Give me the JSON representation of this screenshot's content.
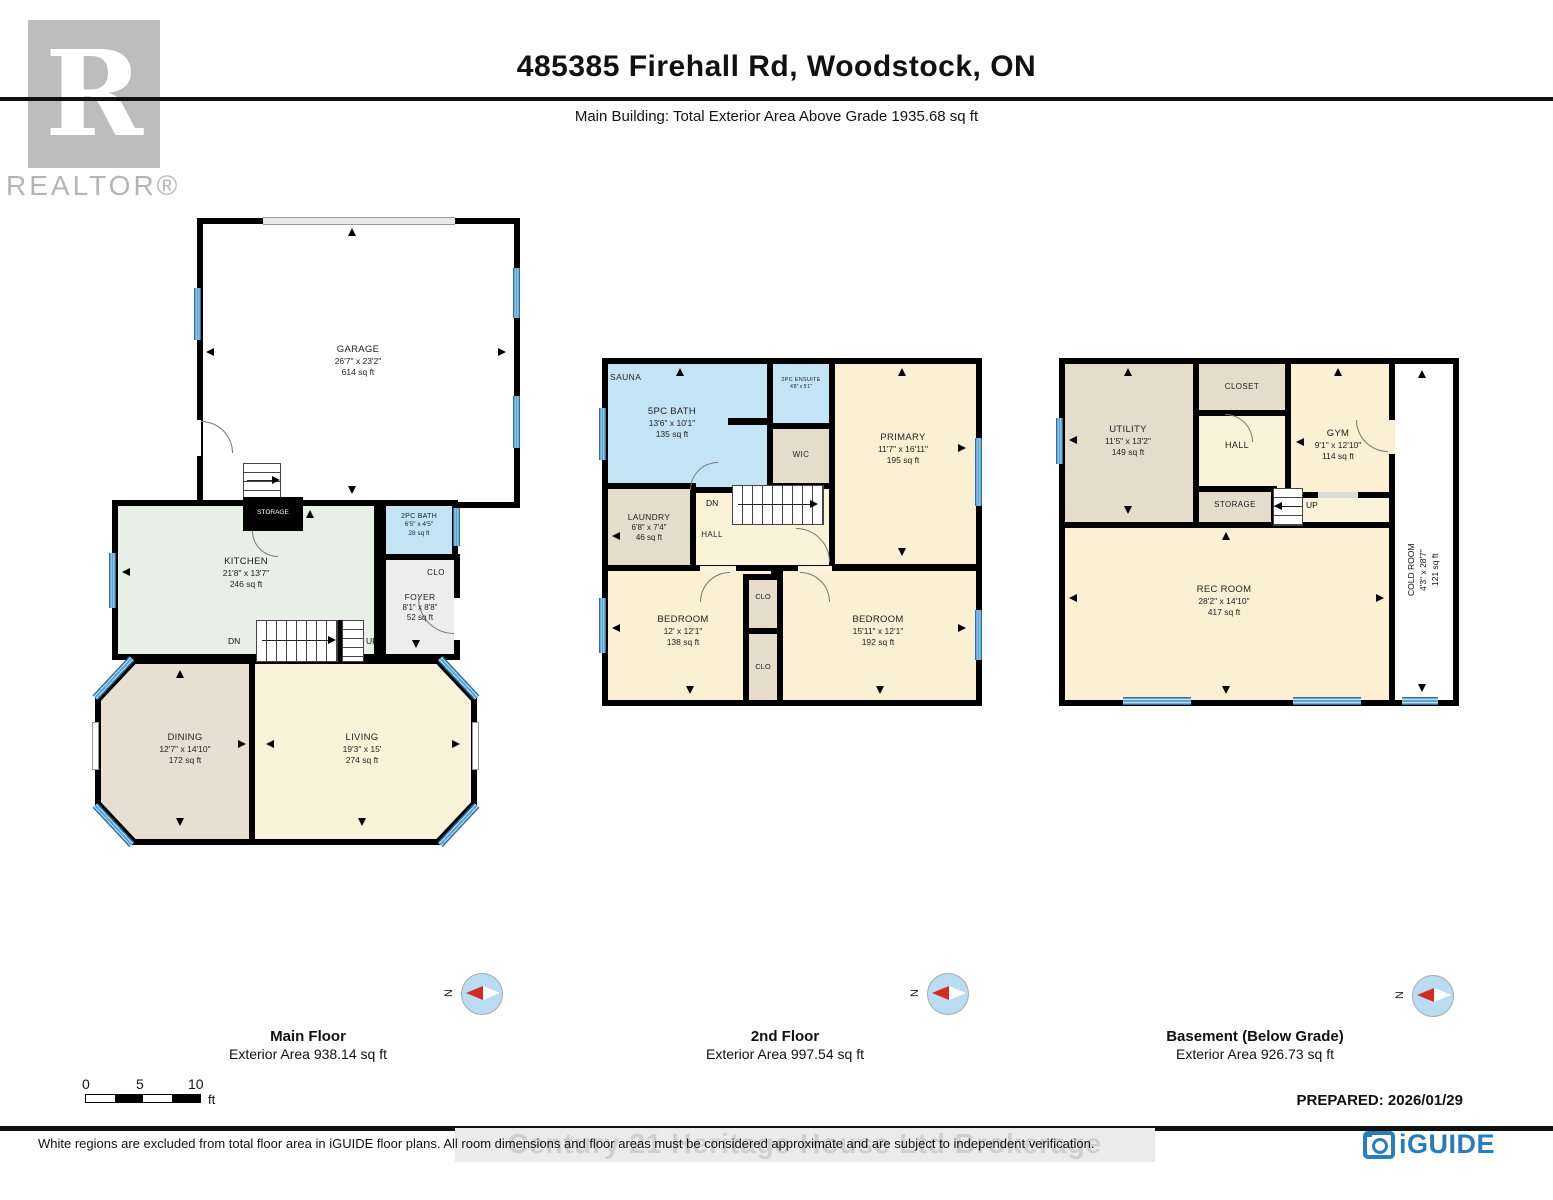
{
  "header": {
    "title": "485385 Firehall Rd, Woodstock, ON",
    "subtitle": "Main Building: Total Exterior Area Above Grade 1935.68 sq ft"
  },
  "branding": {
    "realtor_r": "R",
    "realtor_text": "REALTOR®",
    "iguide_text": "iGUIDE"
  },
  "floors": {
    "main": {
      "caption": {
        "title": "Main Floor",
        "area": "Exterior Area 938.14 sq ft"
      },
      "rooms": {
        "garage": {
          "name": "GARAGE",
          "dims": "26'7\" x 23'2\"",
          "area": "614 sq ft"
        },
        "kitchen": {
          "name": "KITCHEN",
          "dims": "21'8\" x 13'7\"",
          "area": "246 sq ft"
        },
        "bath_2pc": {
          "name": "2PC BATH",
          "dims": "6'5\" x 4'5\"",
          "area": "28 sq ft"
        },
        "closet": {
          "name": "CLO"
        },
        "storage": {
          "name": "STORAGE"
        },
        "foyer": {
          "name": "FOYER",
          "dims": "8'1\" x 8'8\"",
          "area": "52 sq ft"
        },
        "dining": {
          "name": "DINING",
          "dims": "12'7\" x 14'10\"",
          "area": "172 sq ft"
        },
        "living": {
          "name": "LIVING",
          "dims": "19'3\" x 15'",
          "area": "274 sq ft"
        }
      },
      "stairs": {
        "down": "DN",
        "up": "UP"
      }
    },
    "second": {
      "caption": {
        "title": "2nd Floor",
        "area": "Exterior Area 997.54 sq ft"
      },
      "rooms": {
        "sauna": {
          "name": "SAUNA"
        },
        "bath_5pc": {
          "name": "5PC BATH",
          "dims": "13'6\" x 10'1\"",
          "area": "135 sq ft"
        },
        "ensuite_2pc": {
          "name": "2PC ENSUITE",
          "dims": "4'8\" x 5'1\""
        },
        "wic": {
          "name": "WIC"
        },
        "primary": {
          "name": "PRIMARY",
          "dims": "11'7\" x 16'11\"",
          "area": "195 sq ft"
        },
        "laundry": {
          "name": "LAUNDRY",
          "dims": "6'8\" x 7'4\"",
          "area": "46 sq ft"
        },
        "hall": {
          "name": "HALL"
        },
        "bedroom_left": {
          "name": "BEDROOM",
          "dims": "12' x 12'1\"",
          "area": "138 sq ft"
        },
        "bedroom_right": {
          "name": "BEDROOM",
          "dims": "15'11\" x 12'1\"",
          "area": "192 sq ft"
        },
        "closet_upper": {
          "name": "CLO"
        },
        "closet_lower": {
          "name": "CLO"
        }
      },
      "stairs": {
        "down": "DN"
      }
    },
    "basement": {
      "caption": {
        "title": "Basement (Below Grade)",
        "area": "Exterior Area 926.73 sq ft"
      },
      "rooms": {
        "utility": {
          "name": "UTILITY",
          "dims": "11'5\" x 13'2\"",
          "area": "149 sq ft"
        },
        "closet": {
          "name": "CLOSET"
        },
        "hall": {
          "name": "HALL"
        },
        "gym": {
          "name": "GYM",
          "dims": "9'1\" x 12'10\"",
          "area": "114 sq ft"
        },
        "storage": {
          "name": "STORAGE"
        },
        "rec_room": {
          "name": "REC ROOM",
          "dims": "28'2\" x 14'10\"",
          "area": "417 sq ft"
        },
        "cold_room": {
          "name": "COLD ROOM",
          "dims": "4'3\" x 28'7\"",
          "area": "121 sq ft"
        }
      },
      "stairs": {
        "up": "UP"
      }
    }
  },
  "compass": {
    "north": "N"
  },
  "scale_bar": {
    "t0": "0",
    "t5": "5",
    "t10": "10",
    "unit": "ft"
  },
  "footer": {
    "prepared": "PREPARED: 2026/01/29",
    "disclaimer": "White regions are excluded from total floor area in iGUIDE floor plans. All room dimensions and floor areas must be considered approximate and are subject to independent verification.",
    "watermark": "Century 21 Heritage House Ltd Brokerage"
  },
  "colors": {
    "wall": "#000000",
    "window_blue": "#58a6d8",
    "room_cream": "#fbf0d3",
    "room_tan": "#e5dccb",
    "room_blue": "#c3e4f5",
    "room_green": "#e7efe6",
    "room_gray": "#ededed",
    "iguide_blue": "#2b7cb9",
    "compass_red": "#d42a20"
  }
}
